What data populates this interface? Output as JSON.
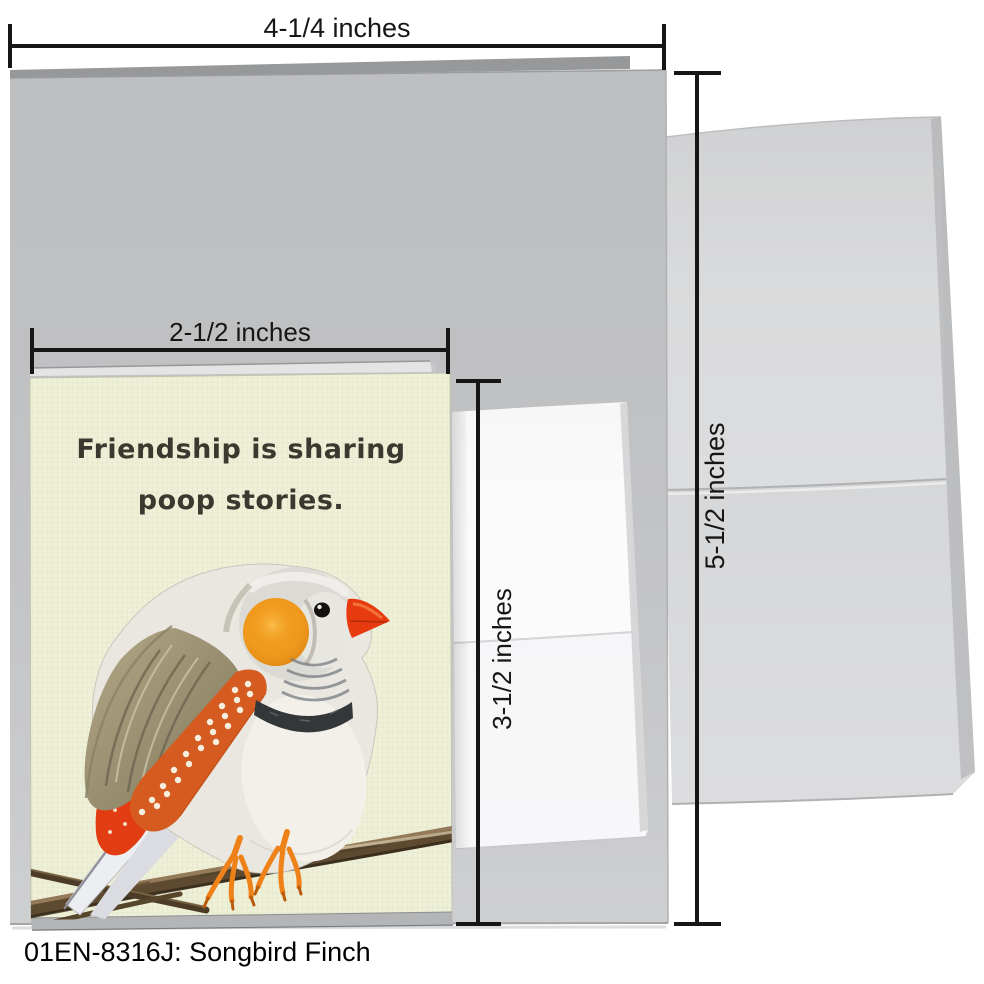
{
  "caption": "01EN-8316J: Songbird Finch",
  "dimensions": {
    "card_width": "4-1/4 inches",
    "card_height": "5-1/2 inches",
    "mini_card_width": "2-1/2 inches",
    "mini_card_height": "3-1/2 inches"
  },
  "mini_card": {
    "message_line1": "Friendship is sharing",
    "message_line2": "poop stories.",
    "background_color": "#eef0d8",
    "text_color": "#3a392f"
  },
  "illustration": {
    "subject": "zebra finch perched on a branch",
    "palette": {
      "body_cream": "#e9e7e0",
      "cheek_orange": "#ef9a1d",
      "beak_red": "#e83a0f",
      "flank_orange": "#d55b20",
      "flank_dots": "#f7eedd",
      "wing_taupe": "#9a8f6e",
      "collar_dark": "#34373a",
      "branch_brown": "#5d4a30",
      "feet_orange": "#ee8118",
      "tail_gray": "#eceef2"
    }
  },
  "colors": {
    "page_background": "#ffffff",
    "large_card_gray": "#c8c9cb",
    "envelope_gray": "#d2d3d5",
    "mini_envelope_white": "#f6f6f8",
    "dimension_line": "#161616"
  }
}
